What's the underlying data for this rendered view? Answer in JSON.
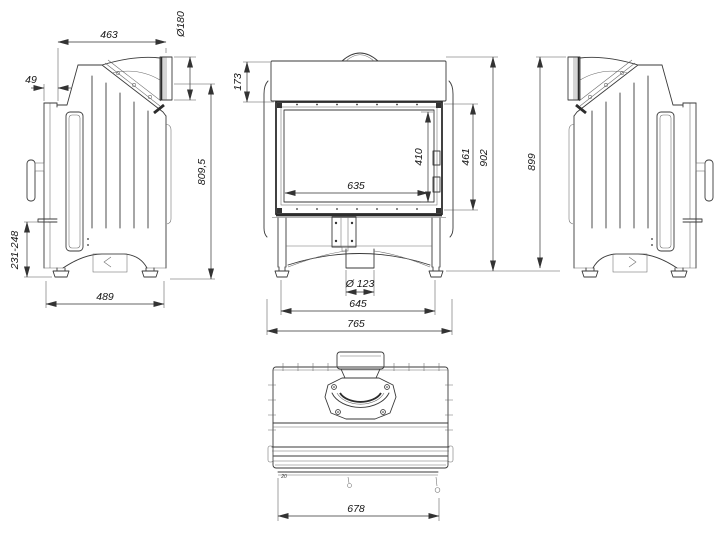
{
  "drawing": {
    "type": "technical-drawing",
    "subject": "fireplace insert multi-view dimensioned drawing",
    "colors": {
      "line": "#3a3a3a",
      "dimension": "#333333",
      "background": "#ffffff"
    },
    "views": {
      "left_side": {
        "name": "left side view"
      },
      "front": {
        "name": "front view"
      },
      "right_side": {
        "name": "right side view"
      },
      "top": {
        "name": "top view"
      }
    }
  },
  "dims": {
    "left": {
      "top_width": "463",
      "flue_diameter": "Ø180",
      "front_offset": "49",
      "base_height": "231-248",
      "flue_axis_height": "809,5",
      "depth": "489"
    },
    "front": {
      "hood_height": "173",
      "glass_width": "635",
      "glass_height": "410",
      "firebox_height": "461",
      "total_height": "902",
      "outlet_diameter": "Ø 123",
      "feet_spacing": "645",
      "total_width": "765"
    },
    "right": {
      "total_height": "899"
    },
    "top": {
      "body_width": "678",
      "note": "20"
    }
  }
}
